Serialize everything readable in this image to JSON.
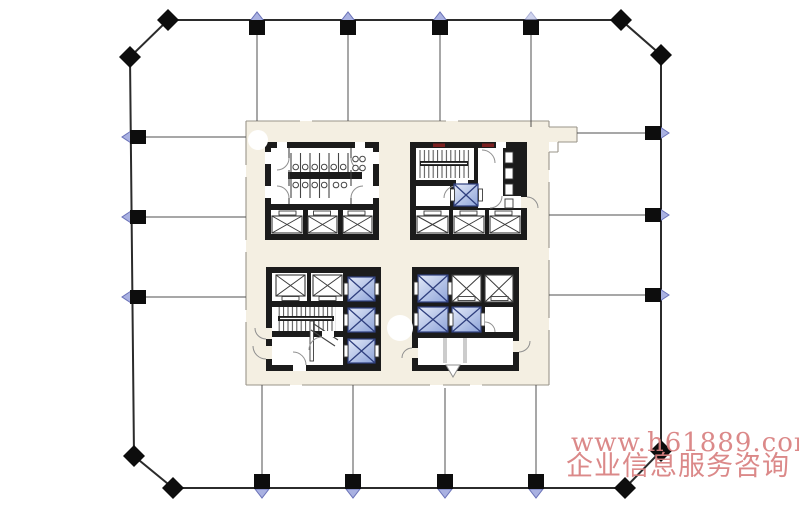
{
  "watermark": {
    "url": "www.h61889.com",
    "caption": "企业信息服务咨询"
  },
  "colors": {
    "bg": "#ffffff",
    "wall": "#1b1b1b",
    "core_fill": "#f4efe2",
    "core_outline": "#9a958a",
    "perimeter": "#2b2b2b",
    "partition": "#4f4f4f",
    "column": "#0d0d0d",
    "marker_fill": "#a9b1e1",
    "marker_stroke": "#6a72b8",
    "elev_stroke": "#3a3a3a",
    "svc_fill_light": "#e3e9f8",
    "svc_fill_dark": "#8ea4d9",
    "svc_stroke": "#2f3f7e",
    "accent_red": "#7c2020",
    "watermark_color": "#d98080",
    "fixture": "#444444"
  },
  "legend": {
    "elevator-icon": "white shaft box with X cross",
    "service-elevator-icon": "blue-shaded shaft box with X cross",
    "stair-icon": "hatched stair run with landing bar",
    "column-icon": "black square column on grid line",
    "column-marker-icon": "pale blue triangle pointing outward",
    "corner-column-icon": "black diamond at chamfered corner",
    "toilet-icon": "small circle within stall partition",
    "door-icon": "quarter-circle swing arc"
  },
  "counts": {
    "perimeter_columns": 22,
    "standard_elevators": 10,
    "highlighted_elevators": 7,
    "stairways": 2,
    "core_blocks": 4
  }
}
